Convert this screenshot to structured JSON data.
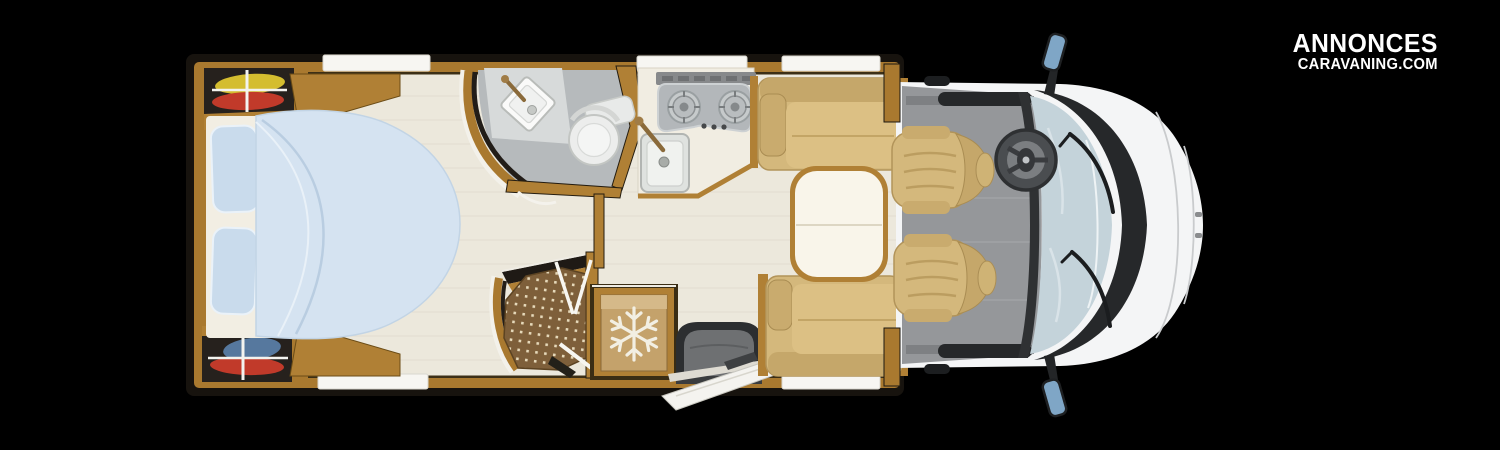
{
  "logo": {
    "line1": "ANNONCES",
    "line2": "CARAVANING.COM"
  },
  "colors": {
    "background": "#000000",
    "wall_dark": "#17130e",
    "wood": "#b08035",
    "wood_deep": "#8a6325",
    "floor": "#ece8dc",
    "window": "#f7f6f2",
    "cushion": "#d4b87c",
    "cushion_dark": "#c5a76a",
    "duvet": "#d5e3f1",
    "pillow": "#c9dbec",
    "bath_floor": "#b6babc",
    "shower_floor": "#7e5f3a",
    "shower_dot": "#e6d9ba",
    "fridge_panel": "#c4a26b",
    "snowflake": "#f2efe3",
    "dark_seat": "#6e7072",
    "cab_floor": "#95979a",
    "windshield": "#c4d3da",
    "cab_body": "#f4f5f6",
    "mirror_glass": "#7fa6c6",
    "table_top": "#f9f5ea",
    "counter": "#f1ede2",
    "hob": "#b3b7ba",
    "steel": "#2f3133",
    "garment_yellow": "#d4bd2f",
    "garment_red": "#c13a2a",
    "garment_blue": "#56789e"
  },
  "floorplan": {
    "description": "motorhome floor plan, top view, cab at right",
    "features": [
      {
        "name": "rear-island-bed"
      },
      {
        "name": "wardrobe-with-hanging-clothes-top"
      },
      {
        "name": "wardrobe-with-hanging-clothes-bottom"
      },
      {
        "name": "washroom-with-toilet-and-basin"
      },
      {
        "name": "shower-cabin"
      },
      {
        "name": "refrigerator-with-snowflake"
      },
      {
        "name": "kitchen-two-burner-hob-and-sink"
      },
      {
        "name": "face-to-face-dinette-with-table"
      },
      {
        "name": "entrance-door-open-with-seat"
      },
      {
        "name": "driver-cab-two-swivel-seats"
      },
      {
        "name": "steering-wheel"
      },
      {
        "name": "windshield-and-mirrors"
      }
    ]
  }
}
